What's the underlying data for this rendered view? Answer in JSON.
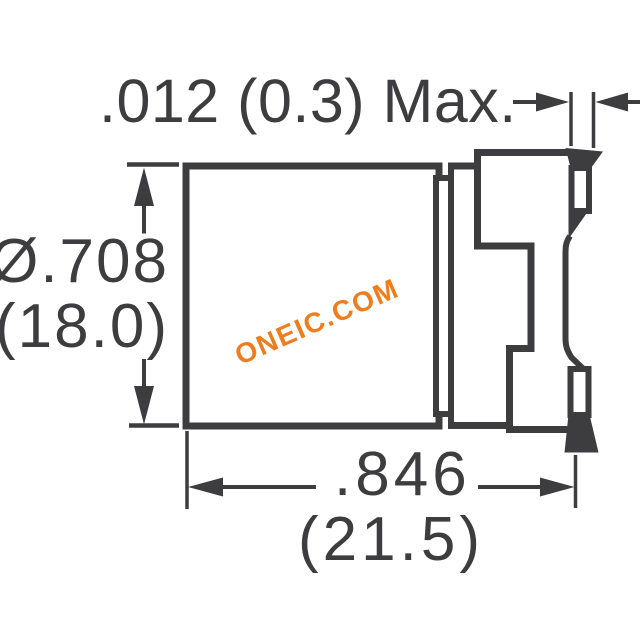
{
  "colors": {
    "line": "#3D3D3F",
    "background": "#FFFFFF",
    "watermark": "#ED7D1F"
  },
  "labels": {
    "top_dimension": ".012 (0.3) Max.",
    "side_dimension_line1": "Ø.708",
    "side_dimension_line2": "(18.0)",
    "bottom_dimension_line1": ".846",
    "bottom_dimension_line2": "(21.5)"
  },
  "watermark": {
    "text": "ONEIC.COM"
  }
}
